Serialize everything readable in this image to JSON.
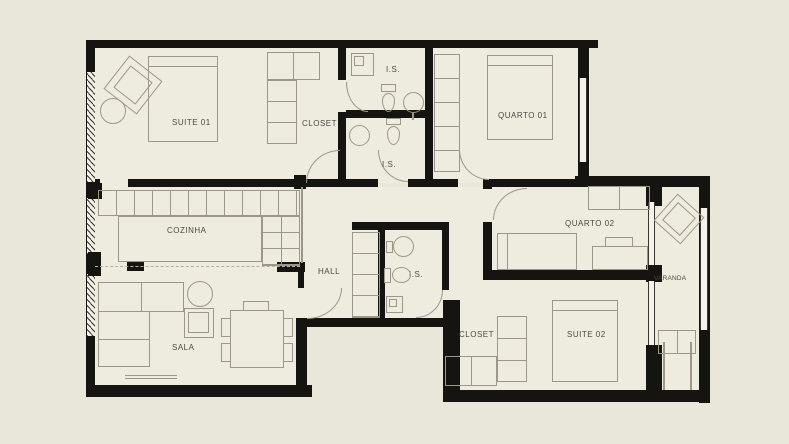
{
  "title": "Apartment floor plan",
  "colors": {
    "background": "#e9e6da",
    "floor": "#eeebdf",
    "wall": "#161410",
    "line": "#9b9889",
    "text": "#4b4943"
  },
  "rooms": {
    "suite01": {
      "label": "SUITE 01"
    },
    "closet01": {
      "label": "CLOSET"
    },
    "is_top": {
      "label": "I.S."
    },
    "is_mid": {
      "label": "I.S."
    },
    "quarto01": {
      "label": "QUARTO 01"
    },
    "cozinha": {
      "label": "COZINHA"
    },
    "hall": {
      "label": "HALL"
    },
    "is_hall": {
      "label": "I.S."
    },
    "quarto02": {
      "label": "QUARTO 02"
    },
    "varanda": {
      "label": "VARANDA"
    },
    "sala": {
      "label": "SALA"
    },
    "closet02": {
      "label": "CLOSET"
    },
    "suite02": {
      "label": "SUITE 02"
    }
  }
}
